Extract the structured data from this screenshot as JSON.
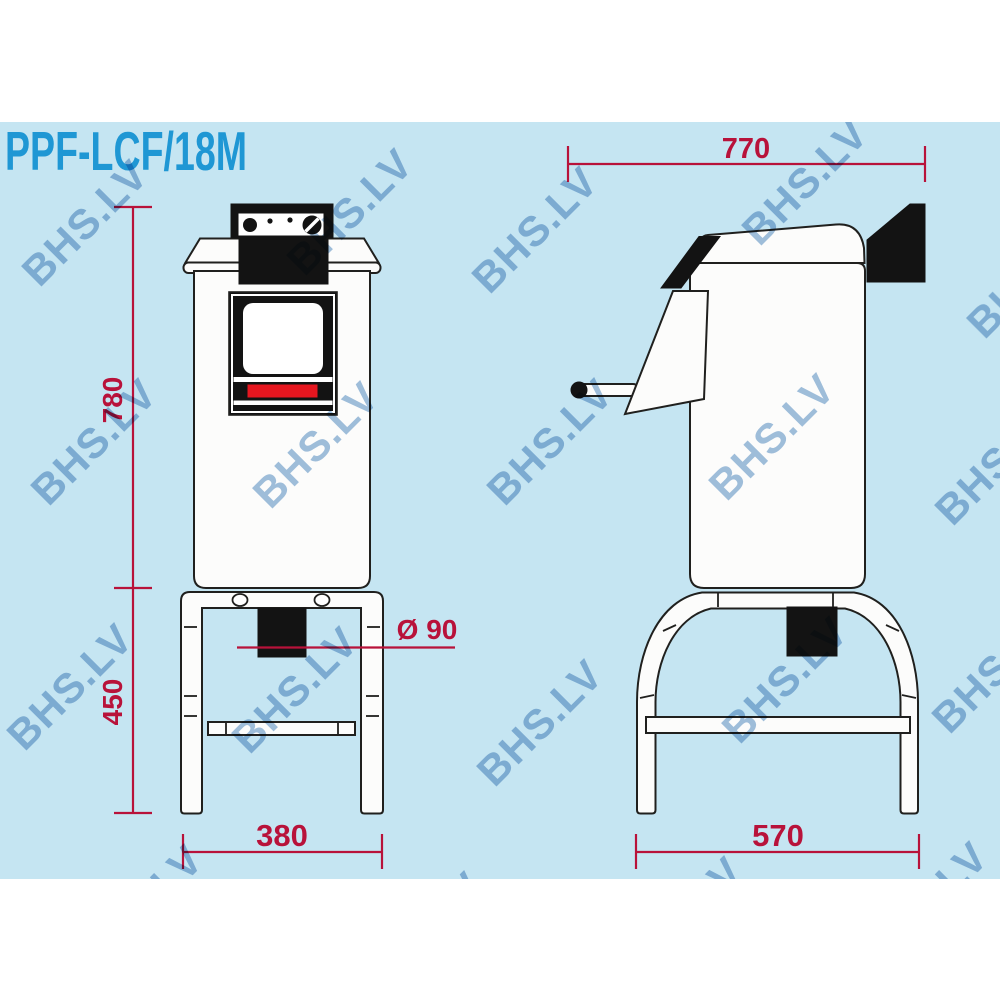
{
  "title": "PPF-LCF/18M",
  "watermark": {
    "text": "BHS.LV"
  },
  "colors": {
    "background": "#c5e5f2",
    "title_blue": "#1f97d4",
    "dimension_red": "#b8123a",
    "door_red": "#e6161f",
    "line": "#20201e",
    "watermark_blue": "#9bbcdc",
    "machine_fill": "#fcfcfb",
    "panel_black": "#131313"
  },
  "front_view": {
    "dim_overall_height": "780",
    "dim_leg_height": "450",
    "dim_width": "380",
    "dim_outlet": "Ø 90"
  },
  "side_view": {
    "dim_depth": "770",
    "dim_leg_depth": "570"
  }
}
